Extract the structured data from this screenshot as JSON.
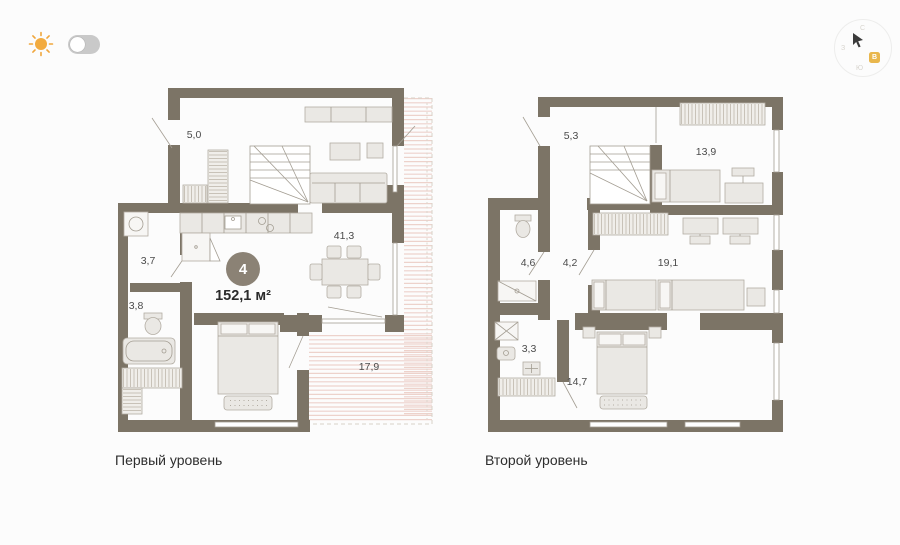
{
  "theme": {
    "toggle_state": "off"
  },
  "compass": {
    "north": "С",
    "west": "З",
    "south": "Ю",
    "east_highlight": "В"
  },
  "summary": {
    "rooms_count": "4",
    "total_area": "152,1 м²"
  },
  "levels": [
    {
      "caption": "Первый уровень",
      "rooms": {
        "hall": "5,0",
        "wc": "3,7",
        "bathroom": "3,8",
        "living": "41,3",
        "terrace": "17,9"
      }
    },
    {
      "caption": "Второй уровень",
      "rooms": {
        "hall": "5,3",
        "bedroom1": "13,9",
        "bathroom": "4,6",
        "corridor": "4,2",
        "bedroom2": "19,1",
        "laundry": "3,3",
        "bedroom3": "14,7"
      }
    }
  ],
  "colors": {
    "wall": "#7c7466",
    "terrace_hatch": "#edd2cb",
    "badge": "#8b8275",
    "sun": "#f0a63c"
  }
}
